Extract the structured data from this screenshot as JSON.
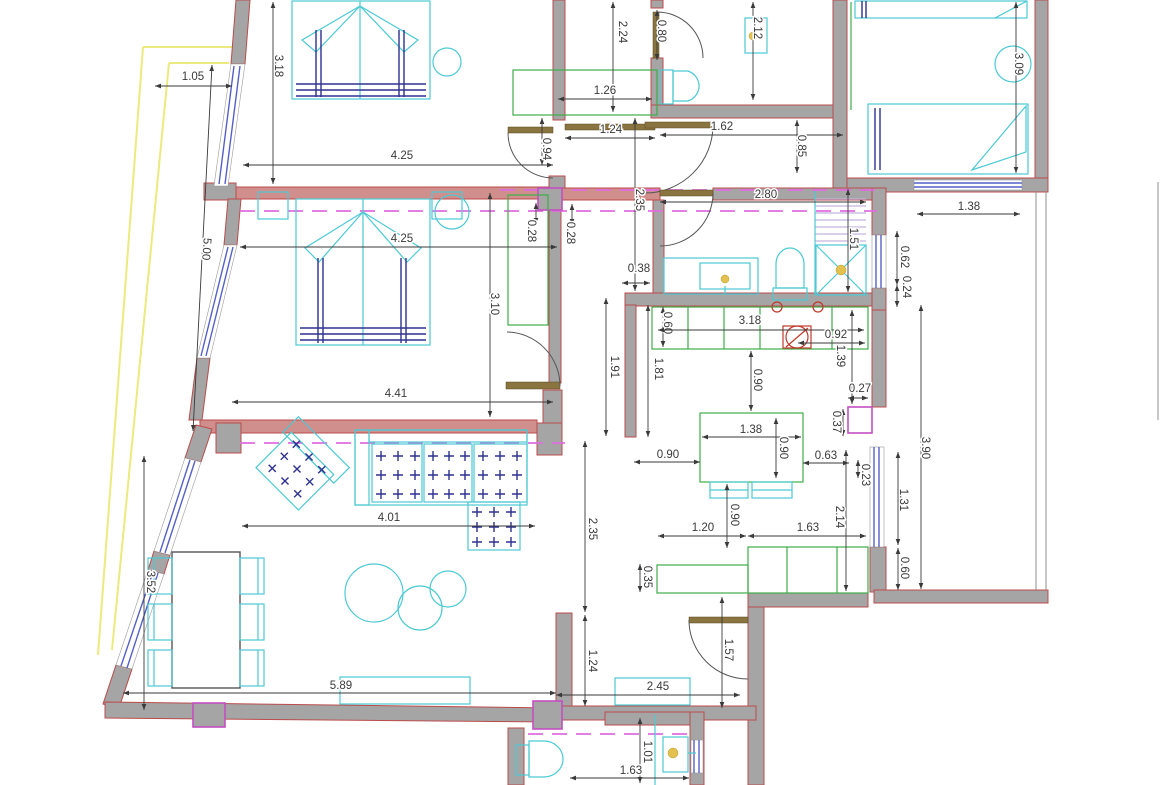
{
  "meta": {
    "kind": "architectural-floor-plan",
    "units": "m"
  },
  "colors": {
    "wall": "#a5a5a5",
    "wallStroke": "#bb4b4b",
    "wallPink": "#d08f8c",
    "furniture": "#4cc9d4",
    "casework": "#3fae49",
    "window": "#5560c8",
    "dim": "#3a3a3a",
    "section": "#df6ddf",
    "accent": "#c24fc2",
    "balcony": "#ece97f",
    "lintel": "#8a7440",
    "cushion": "#2e3191",
    "fixtureDot": "#e2c14f",
    "hatch": "#c3b3dd",
    "fixtureRed": "#c0392b"
  },
  "dimensions": [
    {
      "v": "1.05",
      "x": 193,
      "y": 77,
      "rot": 0,
      "l": [
        155,
        86,
        232,
        86
      ]
    },
    {
      "v": "3.18",
      "x": 278,
      "y": 66,
      "rot": 90,
      "l": [
        273,
        2,
        273,
        184
      ]
    },
    {
      "v": "2.24",
      "x": 622,
      "y": 32,
      "rot": 90,
      "l": [
        613,
        2,
        613,
        112
      ]
    },
    {
      "v": "0.80",
      "x": 661,
      "y": 31,
      "rot": 90,
      "l": [
        657,
        10,
        657,
        60
      ]
    },
    {
      "v": "2.12",
      "x": 757,
      "y": 28,
      "rot": 90,
      "l": [
        753,
        2,
        753,
        100
      ]
    },
    {
      "v": "3.09",
      "x": 1018,
      "y": 64,
      "rot": 90,
      "l": [
        1016,
        2,
        1016,
        173
      ]
    },
    {
      "v": "1.26",
      "x": 605,
      "y": 91,
      "rot": 0,
      "l": [
        558,
        99,
        652,
        99
      ]
    },
    {
      "v": "1.24",
      "x": 611,
      "y": 130,
      "rot": 0,
      "l": [
        565,
        138,
        655,
        138
      ]
    },
    {
      "v": "1.62",
      "x": 722,
      "y": 127,
      "rot": 0,
      "l": [
        660,
        135,
        843,
        135
      ]
    },
    {
      "v": "0.85",
      "x": 801,
      "y": 146,
      "rot": 90,
      "l": [
        797,
        120,
        797,
        173
      ]
    },
    {
      "v": "4.25",
      "x": 402,
      "y": 156,
      "rot": 0,
      "l": [
        243,
        165,
        553,
        165
      ]
    },
    {
      "v": "0.94",
      "x": 546,
      "y": 149,
      "rot": 90,
      "l": [
        542,
        118,
        542,
        165
      ]
    },
    {
      "v": "2.35",
      "x": 639,
      "y": 200,
      "rot": 90,
      "l": [
        635,
        118,
        635,
        291
      ]
    },
    {
      "v": "2.80",
      "x": 766,
      "y": 195,
      "rot": 0,
      "l": [
        660,
        202,
        866,
        202
      ]
    },
    {
      "v": "1.38",
      "x": 969,
      "y": 207,
      "rot": 0,
      "l": [
        917,
        214,
        1020,
        214
      ]
    },
    {
      "v": "5.00",
      "x": 206,
      "y": 249,
      "rot": 94,
      "l": [
        212,
        65,
        193,
        431
      ]
    },
    {
      "v": "0.28",
      "x": 531,
      "y": 231,
      "rot": 90,
      "l": [
        536,
        203,
        536,
        224
      ]
    },
    {
      "v": "0.28",
      "x": 570,
      "y": 233,
      "rot": 90,
      "l": [
        572,
        204,
        572,
        225
      ]
    },
    {
      "v": "4.25",
      "x": 402,
      "y": 239,
      "rot": 0,
      "l": [
        240,
        247,
        557,
        247
      ]
    },
    {
      "v": "1.51",
      "x": 853,
      "y": 239,
      "rot": 90,
      "l": [
        848,
        189,
        848,
        292
      ]
    },
    {
      "v": "0.62",
      "x": 904,
      "y": 257,
      "rot": 90,
      "l": [
        897,
        231,
        897,
        285
      ]
    },
    {
      "v": "0.24",
      "x": 906,
      "y": 287,
      "rot": 90,
      "l": [
        897,
        285,
        897,
        307
      ]
    },
    {
      "v": "0.38",
      "x": 639,
      "y": 269,
      "rot": 0,
      "l": [
        622,
        283,
        650,
        283
      ]
    },
    {
      "v": "3.10",
      "x": 494,
      "y": 304,
      "rot": 90,
      "l": [
        490,
        193,
        490,
        417
      ]
    },
    {
      "v": "0.60",
      "x": 667,
      "y": 323,
      "rot": 90,
      "l": [
        663,
        307,
        663,
        347
      ]
    },
    {
      "v": "3.18",
      "x": 750,
      "y": 321,
      "rot": 0,
      "l": [
        658,
        330,
        864,
        330
      ]
    },
    {
      "v": "0.92",
      "x": 836,
      "y": 335,
      "rot": 0,
      "l": [
        798,
        343,
        865,
        343
      ]
    },
    {
      "v": "1.39",
      "x": 840,
      "y": 356,
      "rot": 90,
      "l": [
        852,
        310,
        852,
        404
      ]
    },
    {
      "v": "1.91",
      "x": 614,
      "y": 367,
      "rot": 90,
      "l": [
        606,
        298,
        606,
        436
      ]
    },
    {
      "v": "1.81",
      "x": 658,
      "y": 369,
      "rot": 90,
      "l": [
        648,
        305,
        648,
        437
      ]
    },
    {
      "v": "0.90",
      "x": 757,
      "y": 380,
      "rot": 90,
      "l": [
        751,
        351,
        751,
        411
      ]
    },
    {
      "v": "0.27",
      "x": 860,
      "y": 389,
      "rot": 0,
      "l": [
        848,
        398,
        868,
        398
      ]
    },
    {
      "v": "4.41",
      "x": 396,
      "y": 394,
      "rot": 0,
      "l": [
        232,
        402,
        553,
        402
      ]
    },
    {
      "v": "0.37",
      "x": 836,
      "y": 422,
      "rot": 90,
      "l": [
        843,
        409,
        843,
        436
      ]
    },
    {
      "v": "1.38",
      "x": 751,
      "y": 430,
      "rot": 0,
      "l": [
        702,
        437,
        801,
        437
      ]
    },
    {
      "v": "0.90",
      "x": 783,
      "y": 448,
      "rot": 90,
      "l": [
        776,
        418,
        776,
        478
      ]
    },
    {
      "v": "3.90",
      "x": 925,
      "y": 448,
      "rot": 90,
      "l": [
        921,
        305,
        921,
        589
      ]
    },
    {
      "v": "0.90",
      "x": 668,
      "y": 455,
      "rot": 0,
      "l": [
        634,
        462,
        700,
        462
      ]
    },
    {
      "v": "0.63",
      "x": 826,
      "y": 456,
      "rot": 0,
      "l": [
        803,
        463,
        849,
        463
      ]
    },
    {
      "v": "0.23",
      "x": 865,
      "y": 475,
      "rot": 90,
      "l": [
        858,
        460,
        858,
        478
      ]
    },
    {
      "v": "1.31",
      "x": 903,
      "y": 500,
      "rot": 90,
      "l": [
        898,
        452,
        898,
        545
      ]
    },
    {
      "v": "4.01",
      "x": 389,
      "y": 518,
      "rot": 0,
      "l": [
        242,
        526,
        535,
        526
      ]
    },
    {
      "v": "2.35",
      "x": 592,
      "y": 529,
      "rot": 90,
      "l": [
        585,
        441,
        585,
        612
      ]
    },
    {
      "v": "0.90",
      "x": 734,
      "y": 515,
      "rot": 90,
      "l": [
        727,
        484,
        727,
        548
      ]
    },
    {
      "v": "2.14",
      "x": 839,
      "y": 517,
      "rot": 90,
      "l": [
        846,
        450,
        846,
        591
      ]
    },
    {
      "v": "1.20",
      "x": 703,
      "y": 528,
      "rot": 0,
      "l": [
        658,
        536,
        746,
        536
      ]
    },
    {
      "v": "1.63",
      "x": 808,
      "y": 528,
      "rot": 0,
      "l": [
        748,
        536,
        866,
        536
      ]
    },
    {
      "v": "0.60",
      "x": 904,
      "y": 568,
      "rot": 90,
      "l": [
        898,
        548,
        898,
        590
      ]
    },
    {
      "v": "3.52",
      "x": 150,
      "y": 582,
      "rot": 90,
      "l": [
        144,
        456,
        144,
        710
      ]
    },
    {
      "v": "0.35",
      "x": 647,
      "y": 577,
      "rot": 90,
      "l": [
        640,
        564,
        640,
        592
      ]
    },
    {
      "v": "1.57",
      "x": 728,
      "y": 650,
      "rot": 90,
      "l": [
        722,
        597,
        722,
        708
      ]
    },
    {
      "v": "1.24",
      "x": 592,
      "y": 661,
      "rot": 90,
      "l": [
        585,
        615,
        585,
        706
      ]
    },
    {
      "v": "5.89",
      "x": 341,
      "y": 686,
      "rot": 0,
      "l": [
        123,
        693,
        556,
        693
      ]
    },
    {
      "v": "2.45",
      "x": 658,
      "y": 687,
      "rot": 0,
      "l": [
        556,
        695,
        740,
        695
      ]
    },
    {
      "v": "1.01",
      "x": 647,
      "y": 752,
      "rot": 90,
      "l": [
        640,
        718,
        640,
        783
      ]
    },
    {
      "v": "1.63",
      "x": 631,
      "y": 771,
      "rot": 0,
      "l": [
        570,
        778,
        689,
        778
      ]
    }
  ],
  "cross_grids": [
    {
      "name": "sofa-seat-1",
      "x": 381,
      "y": 456,
      "dx": 17,
      "dy": 19,
      "nx": 3,
      "ny": 3,
      "rot": 0,
      "cx": 0,
      "cy": 0
    },
    {
      "name": "sofa-seat-2",
      "x": 433,
      "y": 456,
      "dx": 16,
      "dy": 19,
      "nx": 3,
      "ny": 3,
      "rot": 0,
      "cx": 0,
      "cy": 0
    },
    {
      "name": "sofa-seat-3",
      "x": 483,
      "y": 456,
      "dx": 17,
      "dy": 19,
      "nx": 3,
      "ny": 3,
      "rot": 0,
      "cx": 0,
      "cy": 0
    },
    {
      "name": "sofa-chaise",
      "x": 477,
      "y": 512,
      "dx": 17,
      "dy": 15,
      "nx": 3,
      "ny": 3,
      "rot": 0,
      "cx": 0,
      "cy": 0
    },
    {
      "name": "armchair",
      "x": 279,
      "y": 452,
      "dx": 18,
      "dy": 17,
      "nx": 3,
      "ny": 3,
      "rot": 45,
      "cx": 297,
      "cy": 469
    }
  ]
}
